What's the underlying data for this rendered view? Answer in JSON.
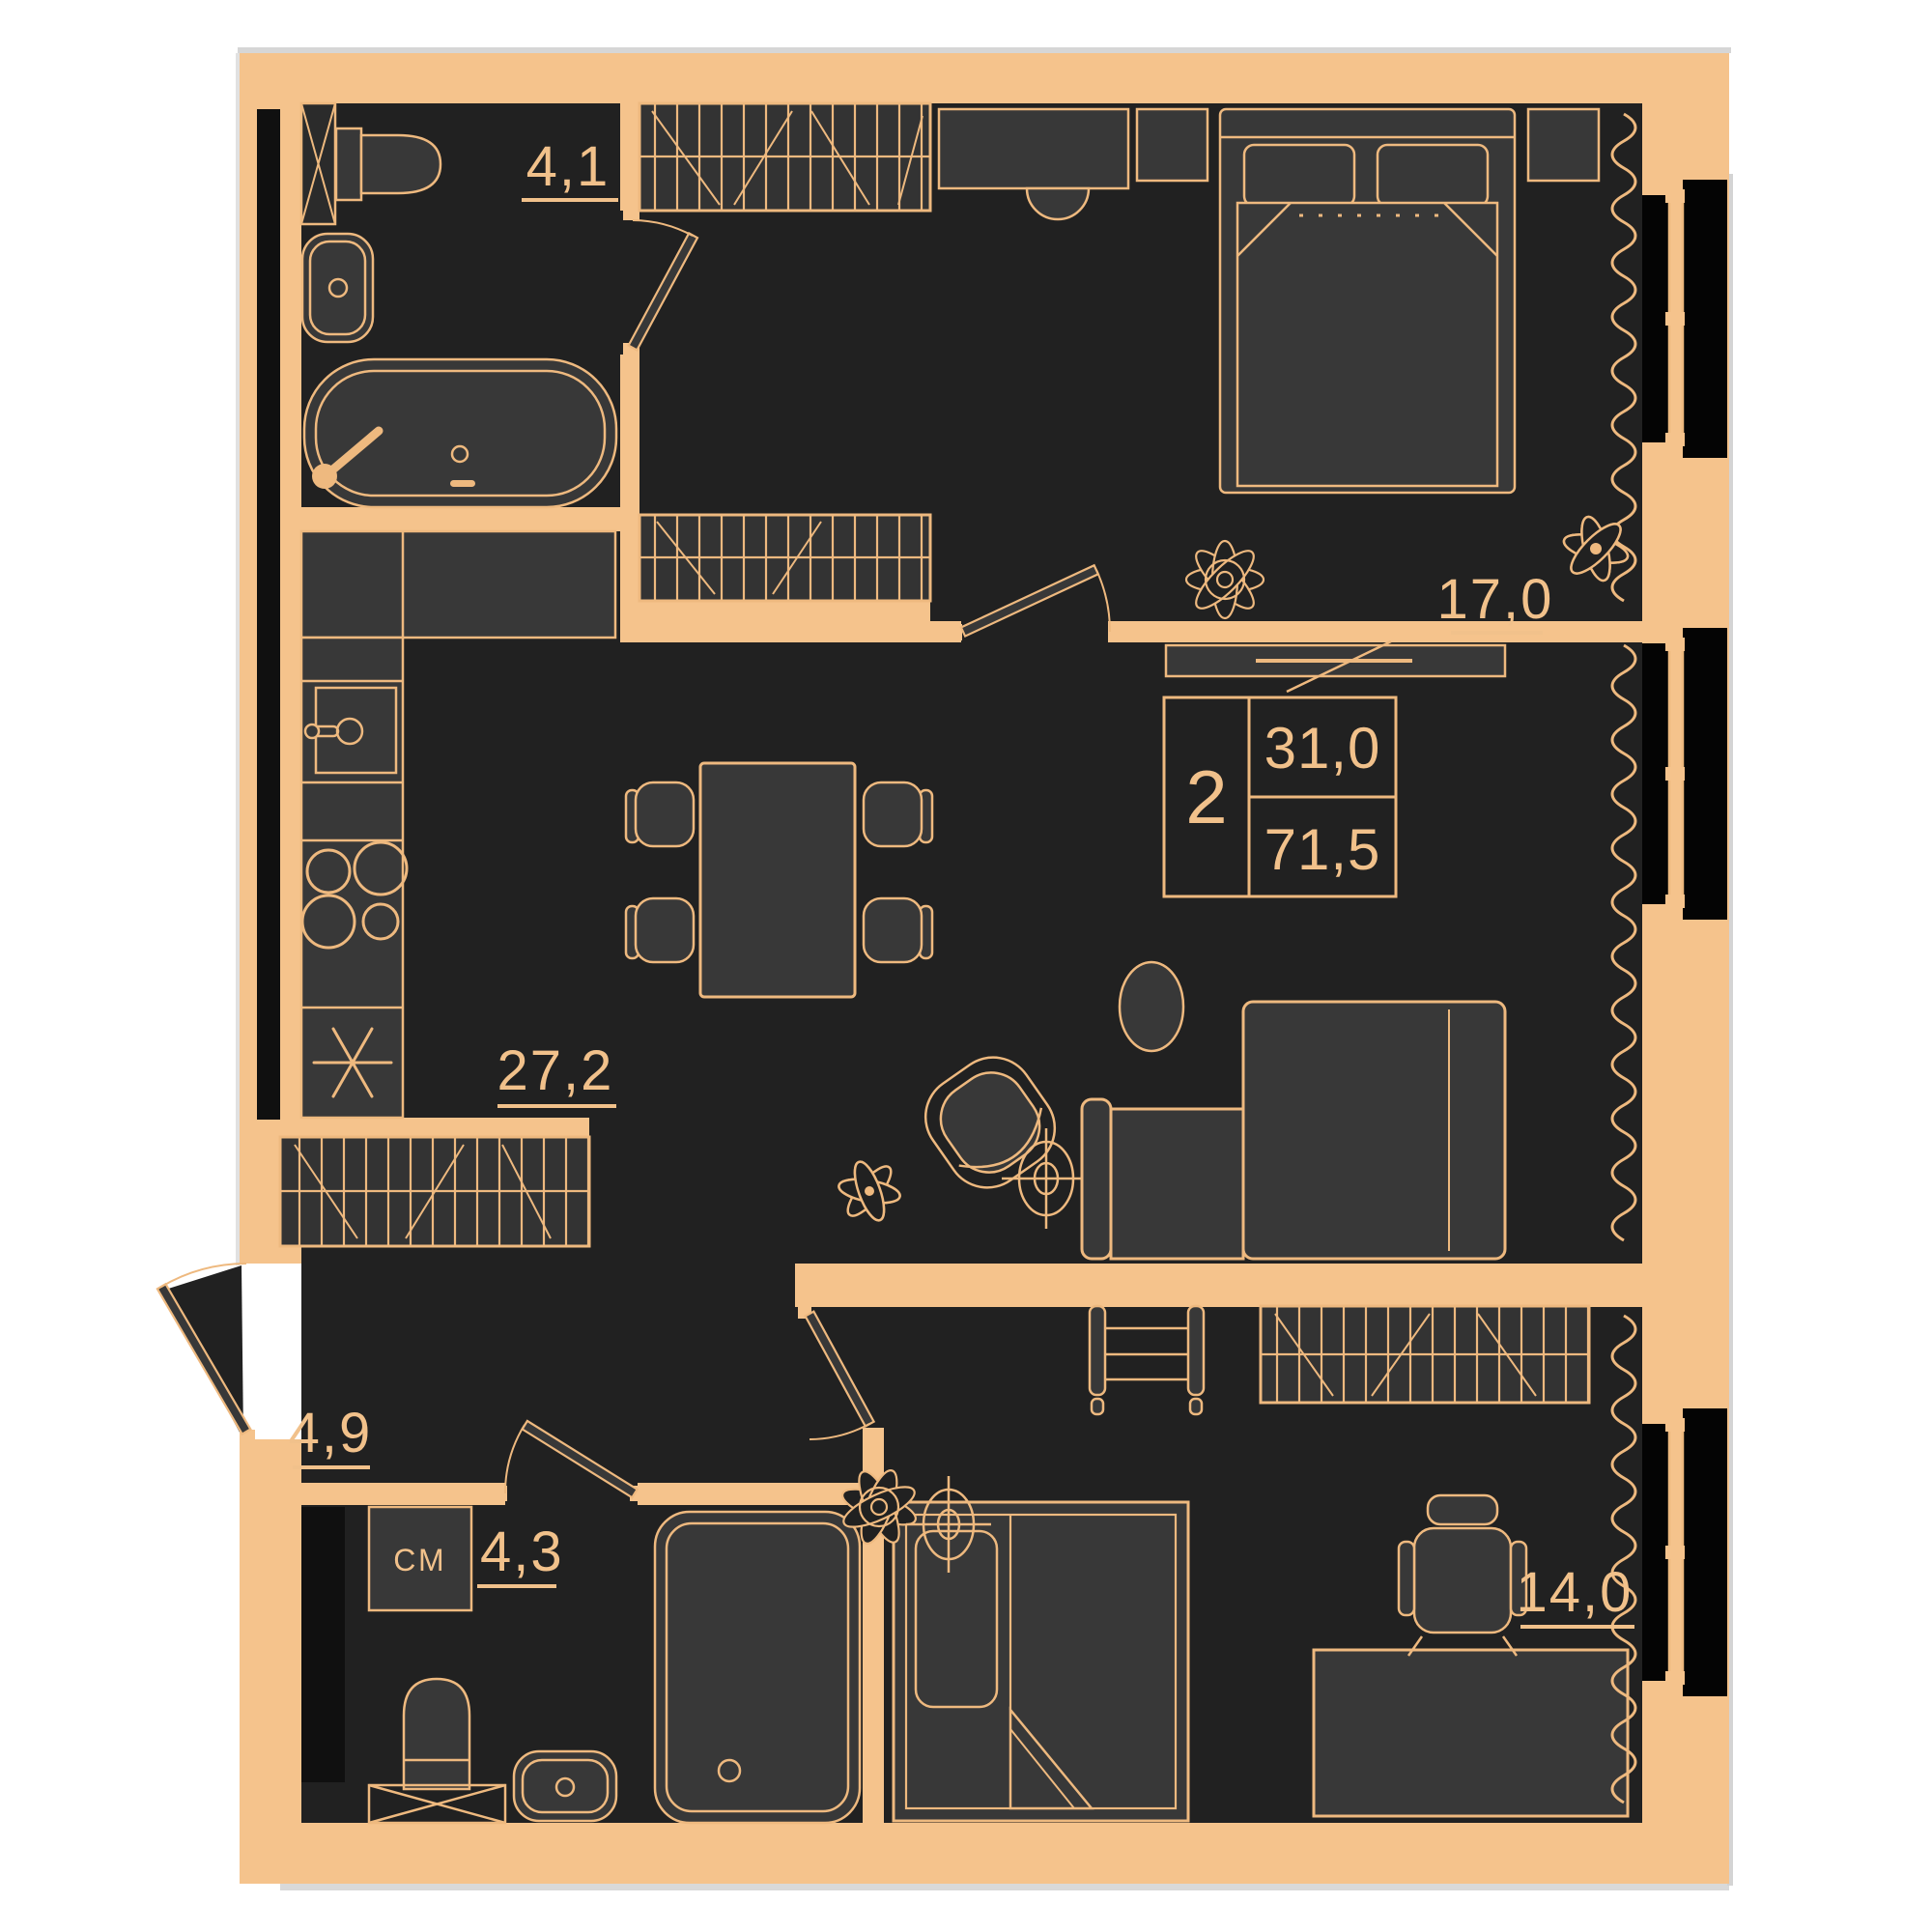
{
  "plan": {
    "type": "apartment-floor-plan",
    "style": "dark interior with tan walls"
  },
  "info_box": {
    "rooms_count": "2",
    "living_area": "31,0",
    "total_area": "71,5"
  },
  "rooms": [
    {
      "id": "bathroom-1",
      "label": "4,1"
    },
    {
      "id": "bedroom-1",
      "label": "17,0"
    },
    {
      "id": "kitchen-living-room",
      "label": "27,2"
    },
    {
      "id": "hallway",
      "label": "4,9"
    },
    {
      "id": "bathroom-2",
      "label": "4,3"
    },
    {
      "id": "bedroom-2",
      "label": "14,0"
    }
  ],
  "appliances": {
    "washing_machine_label": "СМ"
  },
  "colors": {
    "wall": "#f5c38c",
    "line": "#eeb97f",
    "interior": "#212121",
    "furniture": "#383838",
    "glass": "#040404",
    "page": "#ffffff",
    "edge_shadow": "#cccccc",
    "label_text": "#f1c18b"
  }
}
